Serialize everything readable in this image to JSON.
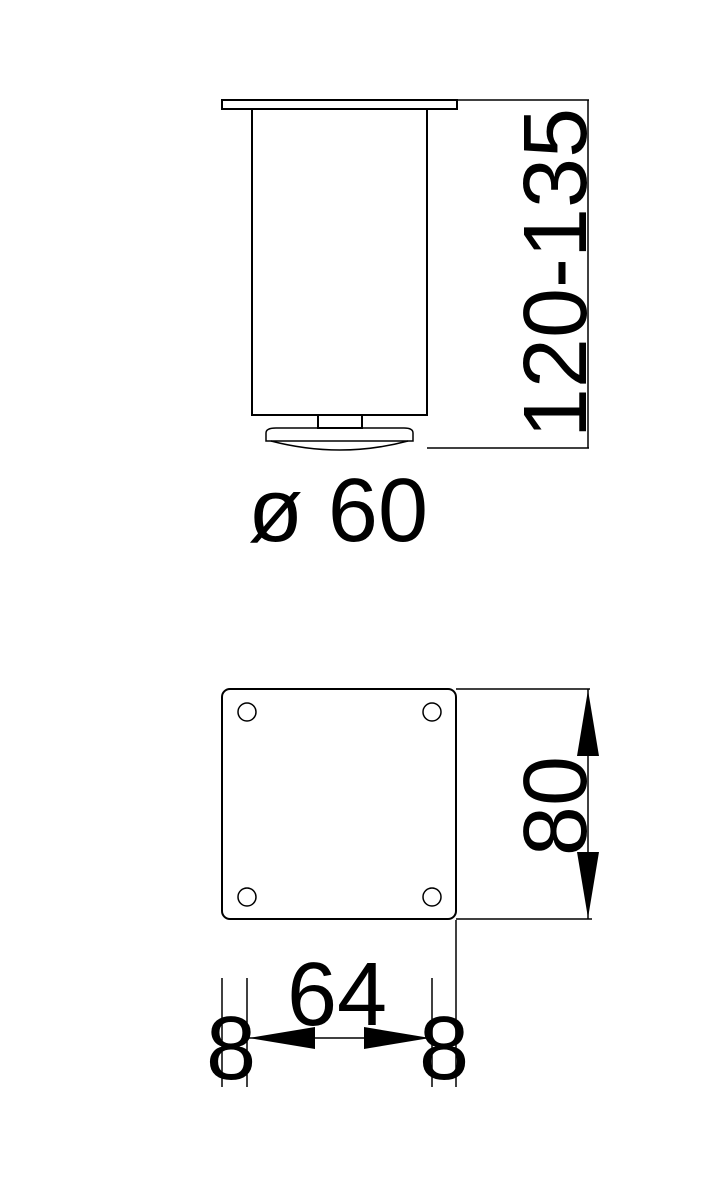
{
  "drawing": {
    "type": "technical-dimension-drawing",
    "background_color": "#ffffff",
    "line_color": "#000000",
    "side_view": {
      "height_range_label": "120-135",
      "diameter_label": "ø 60"
    },
    "plan_view": {
      "plate_width_label": "80",
      "hole_spacing_label": "64",
      "left_edge_offset_label": "8",
      "right_edge_offset_label": "8"
    }
  }
}
